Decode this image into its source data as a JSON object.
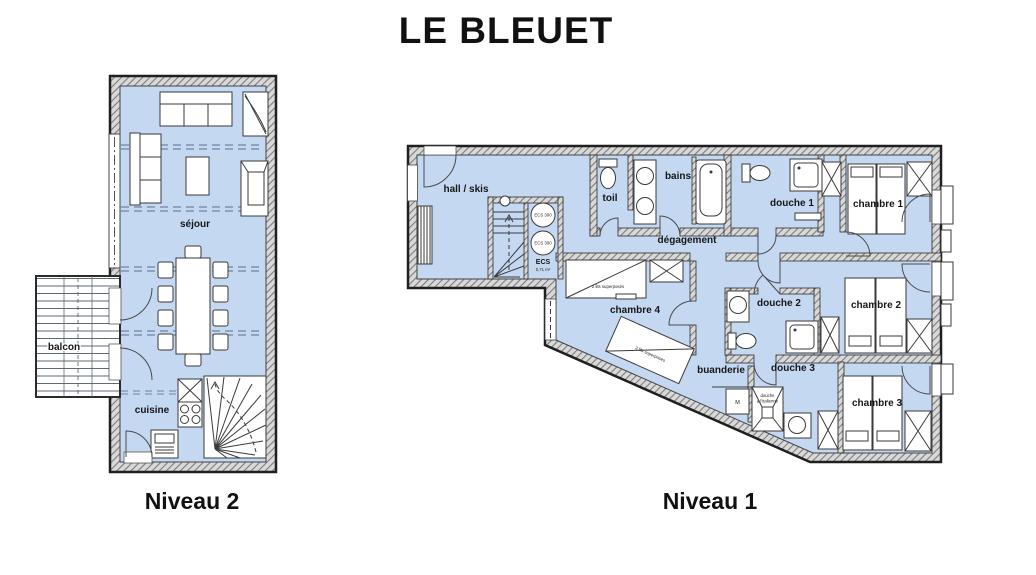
{
  "title": "LE BLEUET",
  "captions": {
    "level2": "Niveau 2",
    "level1": "Niveau 1"
  },
  "colors": {
    "floor": "#c4d9f1",
    "wall_hatch": "#7c7c7c",
    "outline": "#222222",
    "roof_dash": "#7d93ad"
  },
  "level2": {
    "rooms": {
      "sejour": "séjour",
      "cuisine": "cuisine",
      "balcon": "balcon"
    }
  },
  "level1": {
    "rooms": {
      "hall": "hall / skis",
      "toilet": "toil",
      "bath": "bains",
      "shower1": "douche 1",
      "bedroom1": "chambre 1",
      "corridor": "dégagement",
      "bedroom4": "chambre 4",
      "shower2": "douche 2",
      "bedroom2": "chambre 2",
      "laundry": "buanderie",
      "shower3": "douche 3",
      "bedroom3": "chambre 3"
    },
    "annotations": {
      "ecs_tank": "ECS 300",
      "ecs_label": "ECS",
      "ecs_area": "0,71 m²",
      "bunk": "2 lits superposés",
      "italian_shower_line1": "douche",
      "italian_shower_line2": "à l'italienne",
      "washer": "M"
    }
  }
}
